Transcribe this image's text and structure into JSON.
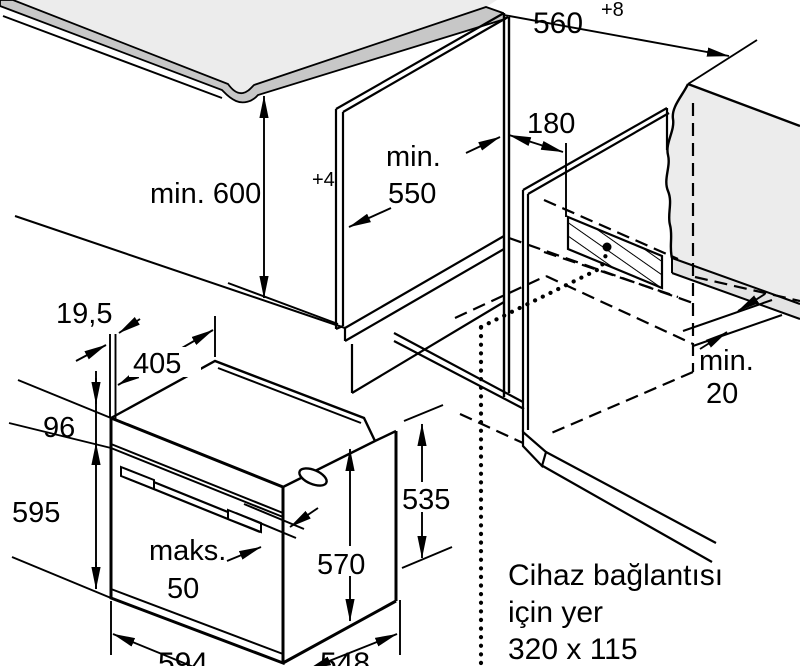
{
  "diagram": {
    "type": "appliance-installation-drawing",
    "subject": "built-in oven niche dimensions",
    "labels": {
      "niche_width": "560",
      "niche_width_sup": "+8",
      "niche_height": "min. 600",
      "niche_height_sup": "+4",
      "niche_depth_1": "min.",
      "niche_depth_2": "550",
      "connection_offset": "180",
      "front_overhang": "19,5",
      "top_depth": "405",
      "panel_height": "96",
      "oven_height": "595",
      "handle_projection_1": "maks.",
      "handle_projection_2": "50",
      "oven_width": "594",
      "oven_inner_height": "570",
      "oven_rear_height": "535",
      "oven_depth": "548",
      "rear_gap_1": "min.",
      "rear_gap_2": "20",
      "connection_note_1": "Cihaz bağlantısı",
      "connection_note_2": "için yer",
      "connection_note_3": "320 x 115"
    },
    "colors": {
      "line": "#000000",
      "worktop_surface": "#ececec",
      "worktop_edge": "#c7c7c7",
      "wall_surface": "#ececec",
      "floor_strip": "#e3e3e3",
      "background": "#ffffff"
    }
  }
}
